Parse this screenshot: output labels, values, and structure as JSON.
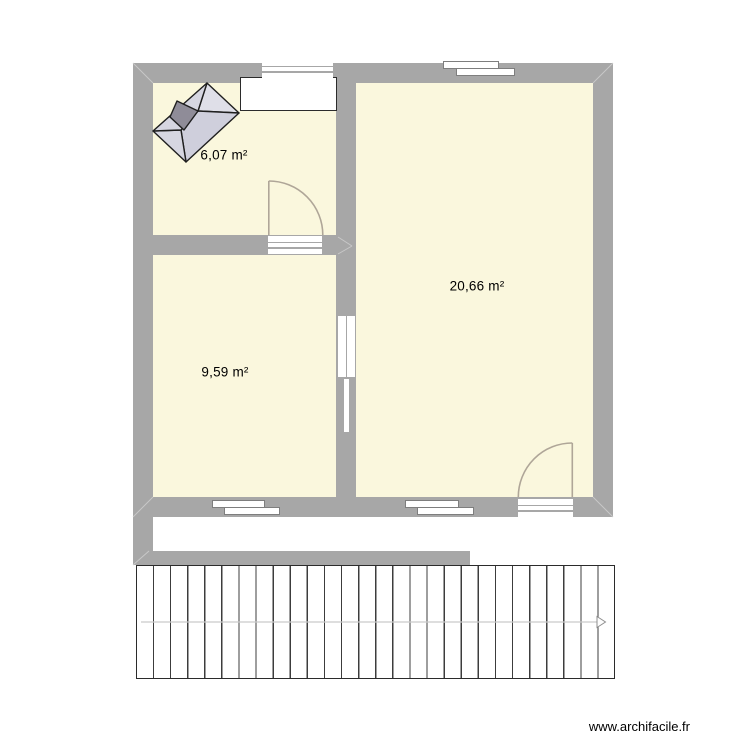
{
  "rooms": [
    {
      "id": "room-1",
      "area": "6,07 m²"
    },
    {
      "id": "room-2",
      "area": "9,59 m²"
    },
    {
      "id": "room-3",
      "area": "20,66 m²"
    }
  ],
  "footer": {
    "watermark": "www.archifacile.fr"
  },
  "icons": [
    {
      "name": "roof-icon",
      "meaning": "hip roof object placed in room 1"
    },
    {
      "name": "arrow-right-icon",
      "meaning": "stair direction arrow"
    }
  ],
  "colors": {
    "wall": "#a7a7a7",
    "room_fill": "#faf7dd",
    "door_swing": "#afa698",
    "plan_outline": "#2b2b2b",
    "stair_tread_line": "#3c3c3c",
    "stair_axis_line": "#c9c9c9",
    "roof_light": "#dfdfe8",
    "roof_mid": "#cfcfdc",
    "roof_chimney": "#8f8c98"
  }
}
